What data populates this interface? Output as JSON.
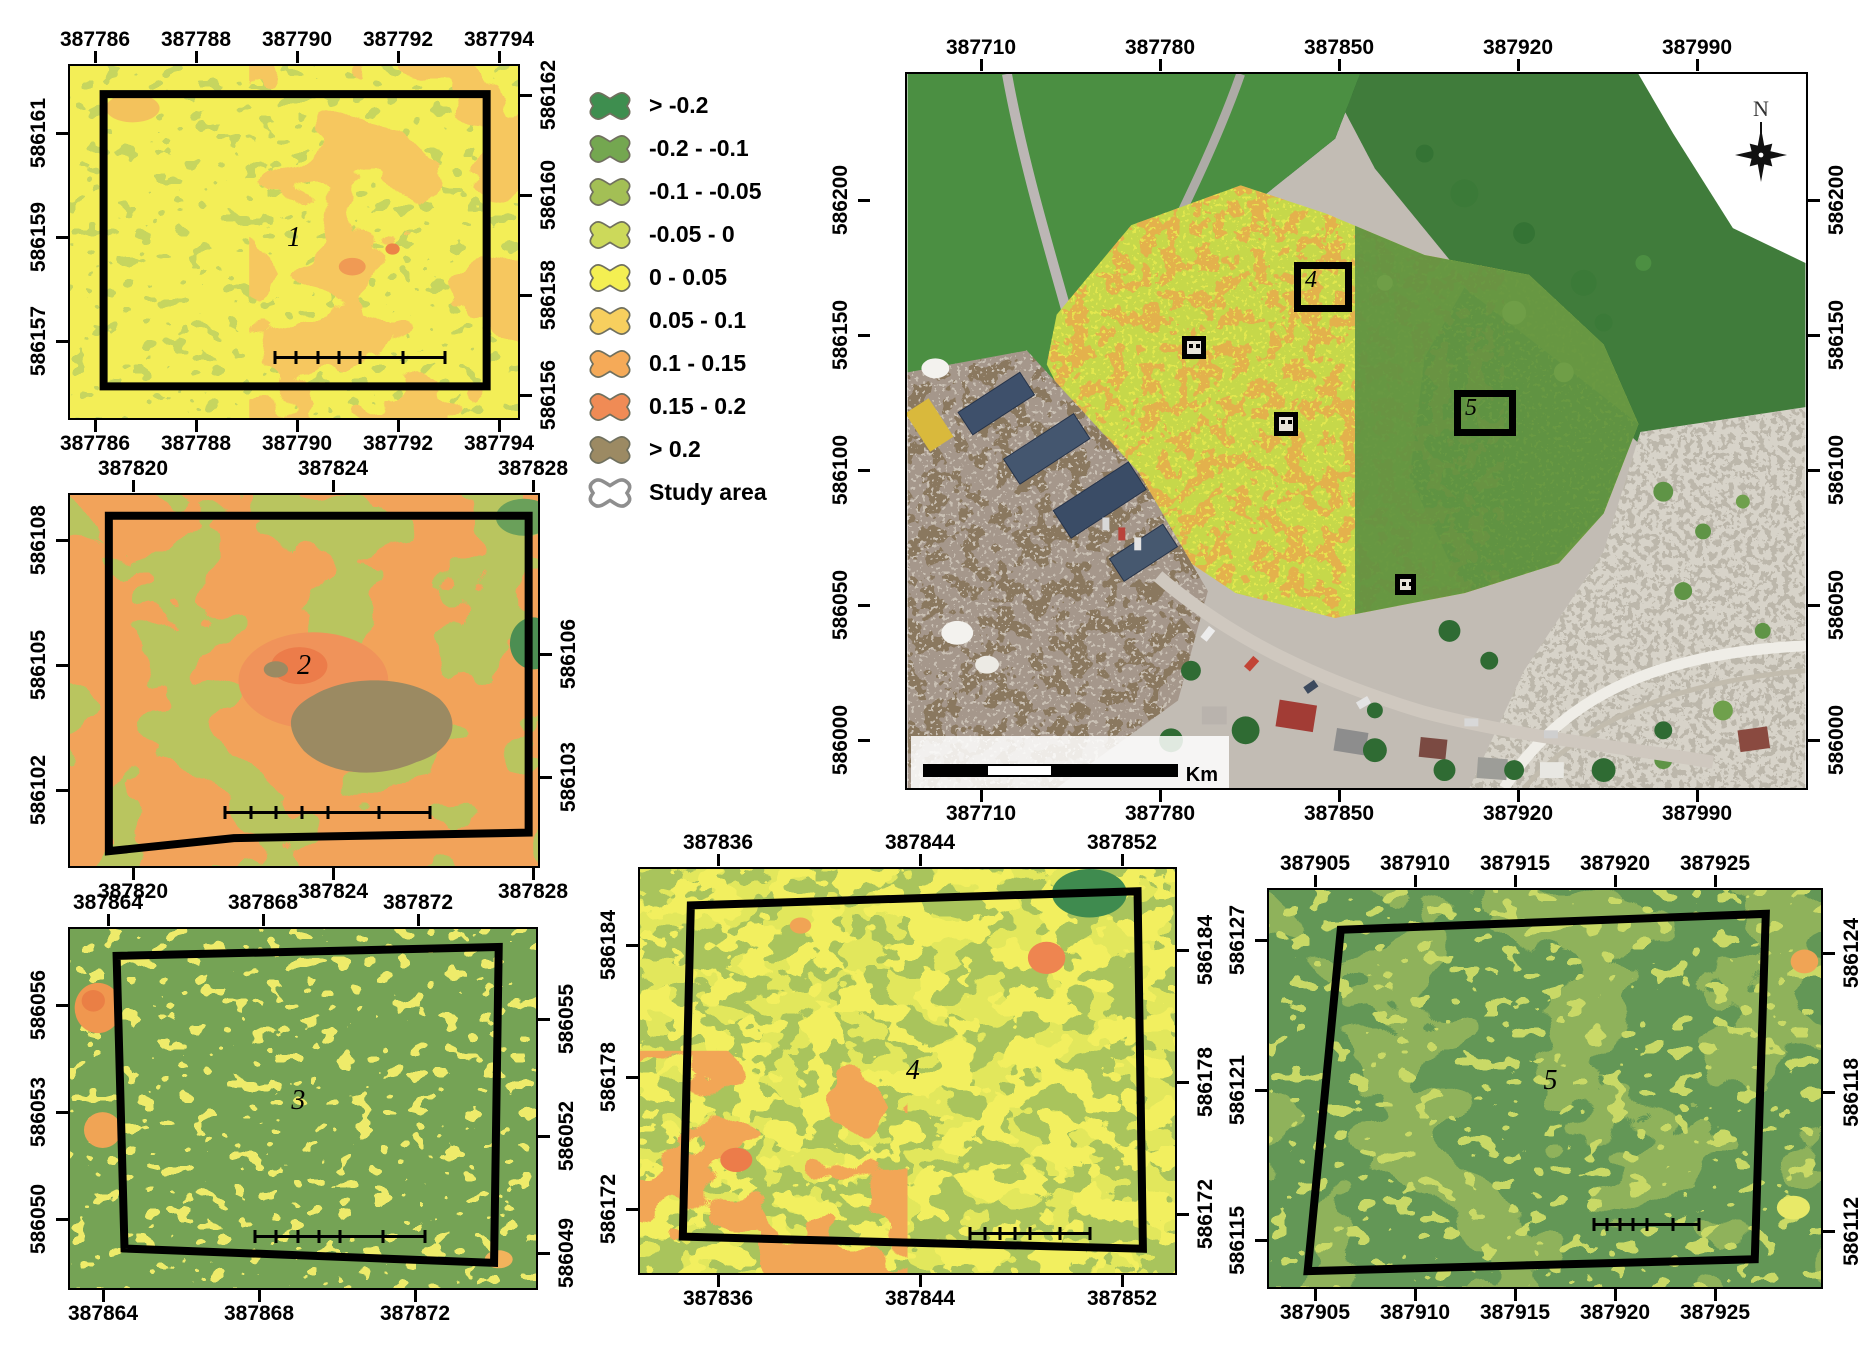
{
  "legend": {
    "title_lines": [
      "Surface",
      "movement [cm]",
      "2017-2019"
    ],
    "items": [
      {
        "label": "> -0.2",
        "color": "#3e8e4f"
      },
      {
        "label": "-0.2 - -0.1",
        "color": "#74a750"
      },
      {
        "label": "-0.1 - -0.05",
        "color": "#a3bf55"
      },
      {
        "label": "-0.05 - 0",
        "color": "#ccd95a"
      },
      {
        "label": "0 - 0.05",
        "color": "#f4ef52"
      },
      {
        "label": "0.05 - 0.1",
        "color": "#f7cf5e"
      },
      {
        "label": "0.1 - 0.15",
        "color": "#f5aa58"
      },
      {
        "label": "0.15 - 0.2",
        "color": "#f08b55"
      },
      {
        "label": "> 0.2",
        "color": "#9c8a63"
      },
      {
        "label": "Study area",
        "color": "#ffffff",
        "outline": "thick"
      }
    ]
  },
  "maps": {
    "map1": {
      "number": "1",
      "axis_top": [
        "387786",
        "387788",
        "387790",
        "387792",
        "387794"
      ],
      "axis_bottom": [
        "387786",
        "387788",
        "387790",
        "387792",
        "387794"
      ],
      "axis_left": [
        "586161",
        "586159",
        "586157"
      ],
      "axis_right": [
        "586162",
        "586160",
        "586158",
        "586156"
      ],
      "scalebar_labels": [
        "0",
        "1",
        "2",
        "4 m"
      ]
    },
    "map2": {
      "number": "2",
      "axis_top": [
        "387820",
        "387824",
        "387828"
      ],
      "axis_bottom": [
        "387820",
        "387824",
        "387828"
      ],
      "axis_left": [
        "586108",
        "586105",
        "586102"
      ],
      "axis_right": [
        "586106",
        "586103"
      ],
      "scalebar_labels": [
        "0",
        "1",
        "2",
        "4 m"
      ]
    },
    "map3": {
      "number": "3",
      "axis_top": [
        "387864",
        "387868",
        "387872"
      ],
      "axis_bottom": [
        "387864",
        "387868",
        "387872"
      ],
      "axis_left": [
        "586056",
        "586053",
        "586050"
      ],
      "axis_right": [
        "586055",
        "586052",
        "586049"
      ],
      "scalebar_labels": [
        "0",
        "1",
        "2",
        "4 m"
      ]
    },
    "map4": {
      "number": "4",
      "axis_top": [
        "387836",
        "387844",
        "387852"
      ],
      "axis_bottom": [
        "387836",
        "387844",
        "387852"
      ],
      "axis_left": [
        "586184",
        "586178",
        "586172"
      ],
      "axis_right": [
        "586184",
        "586178",
        "586172"
      ],
      "scalebar_labels": [
        "0",
        "1",
        "2",
        "4 m"
      ]
    },
    "map5": {
      "number": "5",
      "axis_top": [
        "387905",
        "387910",
        "387915",
        "387920",
        "387925"
      ],
      "axis_bottom": [
        "387905",
        "387910",
        "387915",
        "387920",
        "387925"
      ],
      "axis_left": [
        "586127",
        "586121",
        "586115"
      ],
      "axis_right": [
        "586124",
        "586118",
        "586112"
      ],
      "scalebar_labels": [
        "0",
        "1",
        "2",
        "4 m"
      ]
    },
    "main": {
      "axis_top": [
        "387710",
        "387780",
        "387850",
        "387920",
        "387990"
      ],
      "axis_bottom": [
        "387710",
        "387780",
        "387850",
        "387920",
        "387990"
      ],
      "axis_left": [
        "586200",
        "586150",
        "586100",
        "586050",
        "586000"
      ],
      "axis_right": [
        "586200",
        "586150",
        "586100",
        "586050",
        "586000"
      ],
      "scalebar_labels": [
        "0",
        "0.025",
        "0.05",
        "0.1"
      ],
      "scalebar_unit": "Km",
      "north_label": "N",
      "marker4_label": "4",
      "marker5_label": "5"
    }
  }
}
